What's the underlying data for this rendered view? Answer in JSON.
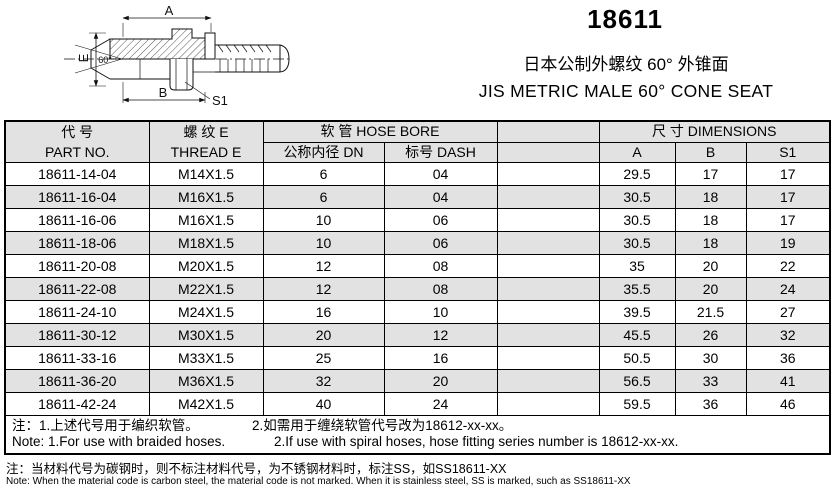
{
  "page": {
    "series_code": "18611",
    "subtitle_cn": "日本公制外螺纹 60° 外锥面",
    "subtitle_en": "JIS METRIC MALE 60° CONE SEAT"
  },
  "drawing": {
    "dim_a": "A",
    "dim_b": "B",
    "dim_e": "E",
    "dim_s1": "S1",
    "angle": "60°"
  },
  "table": {
    "header": {
      "part_no_cn": "代  号",
      "part_no_en": "PART NO.",
      "thread_cn": "螺  纹  E",
      "thread_en": "THREAD  E",
      "hose_bore": "软  管  HOSE BORE",
      "dn": "公称内径  DN",
      "dash": "标号  DASH",
      "blank": "",
      "dimensions": "尺  寸  DIMENSIONS",
      "dim_a": "A",
      "dim_b": "B",
      "dim_s1": "S1"
    },
    "rows": [
      [
        "18611-14-04",
        "M14X1.5",
        "6",
        "04",
        "",
        "29.5",
        "17",
        "17"
      ],
      [
        "18611-16-04",
        "M16X1.5",
        "6",
        "04",
        "",
        "30.5",
        "18",
        "17"
      ],
      [
        "18611-16-06",
        "M16X1.5",
        "10",
        "06",
        "",
        "30.5",
        "18",
        "17"
      ],
      [
        "18611-18-06",
        "M18X1.5",
        "10",
        "06",
        "",
        "30.5",
        "18",
        "19"
      ],
      [
        "18611-20-08",
        "M20X1.5",
        "12",
        "08",
        "",
        "35",
        "20",
        "22"
      ],
      [
        "18611-22-08",
        "M22X1.5",
        "12",
        "08",
        "",
        "35.5",
        "20",
        "24"
      ],
      [
        "18611-24-10",
        "M24X1.5",
        "16",
        "10",
        "",
        "39.5",
        "21.5",
        "27"
      ],
      [
        "18611-30-12",
        "M30X1.5",
        "20",
        "12",
        "",
        "45.5",
        "26",
        "32"
      ],
      [
        "18611-33-16",
        "M33X1.5",
        "25",
        "16",
        "",
        "50.5",
        "30",
        "36"
      ],
      [
        "18611-36-20",
        "M36X1.5",
        "32",
        "20",
        "",
        "56.5",
        "33",
        "41"
      ],
      [
        "18611-42-24",
        "M42X1.5",
        "40",
        "24",
        "",
        "59.5",
        "36",
        "46"
      ]
    ],
    "notes": {
      "cn_1": "注：1.上述代号用于编织软管。",
      "cn_2": "2.如需用于缠绕软管代号改为18612-xx-xx。",
      "en_1": "Note: 1.For use with braided hoses.",
      "en_2": "2.If use with spiral hoses, hose fitting series number is 18612-xx-xx."
    }
  },
  "footnotes": {
    "cn": "注：当材料代号为碳钢时，则不标注材料代号，为不锈钢材料时，标注SS，如SS18611-XX",
    "en": "Note: When the material code is carbon steel, the material code is not marked. When it is stainless steel, SS is marked, such as SS18611-XX"
  },
  "colors": {
    "stripe": "#e2e2e2",
    "line": "#000000",
    "background": "#ffffff"
  }
}
